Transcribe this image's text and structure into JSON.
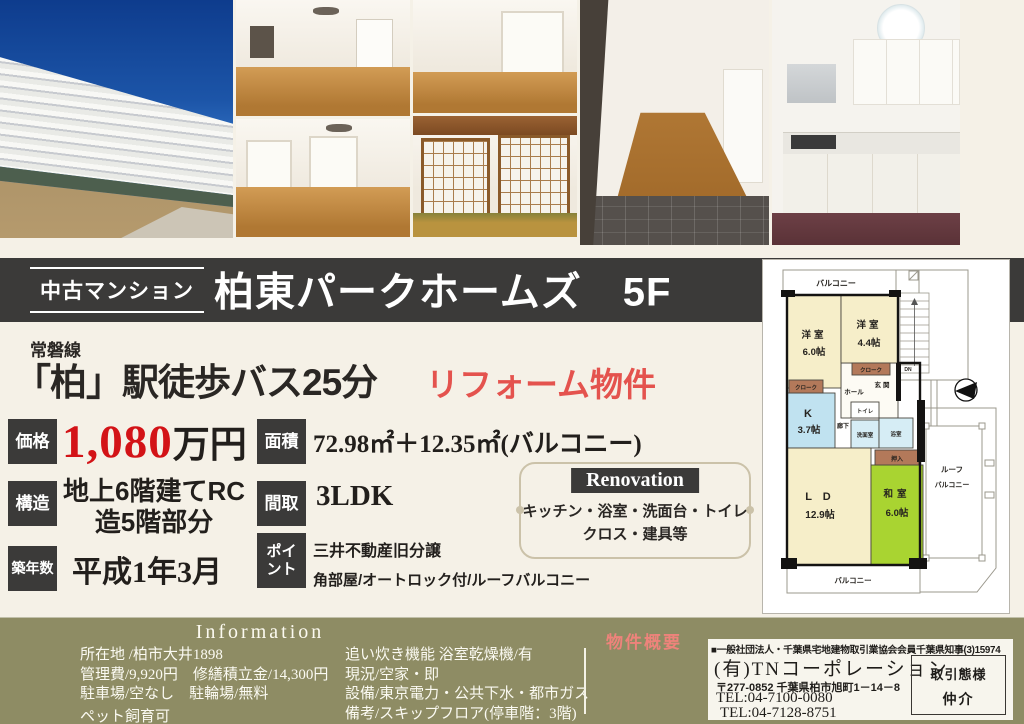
{
  "colors": {
    "background_cream": "#f5f1e7",
    "bar_charcoal": "#3b3a39",
    "price_red": "#d31317",
    "accent_coral": "#e4534e",
    "info_olive": "#8e8c64",
    "overview_pink": "#ee837b",
    "plan_room_cream": "#f6eec9",
    "plan_tatami_green": "#a9d431",
    "plan_kitchen_blue": "#c0e2f0",
    "plan_closet_brown": "#b3795a"
  },
  "title_bar": {
    "badge": "中古マンション",
    "title": "柏東パークホームズ　5F"
  },
  "catch": {
    "rail_line": "常磐線",
    "main": "「柏」駅徒歩バス25分",
    "accent": "リフォーム物件"
  },
  "specs": {
    "price": {
      "label": "価格",
      "number": "1,080",
      "unit": "万円"
    },
    "structure": {
      "label": "構造",
      "line1": "地上6階建てRC",
      "line2": "造5階部分"
    },
    "age": {
      "label": "築年数",
      "value": "平成1年3月"
    },
    "area": {
      "label": "面積",
      "value": "72.98㎡＋12.35㎡(バルコニー)"
    },
    "layout": {
      "label": "間取",
      "value": "3LDK"
    },
    "point": {
      "label1": "ポイ",
      "label2": "ント",
      "line1": "三井不動産旧分譲",
      "line2": "角部屋/オートロック付/ルーフバルコニー"
    }
  },
  "renovation": {
    "label": "Renovation",
    "line1": "キッチン・浴室・洗面台・トイレ",
    "line2": "クロス・建具等"
  },
  "floorplan": {
    "balcony_top": "バルコニー",
    "room1_name": "洋室",
    "room1_size": "6.0帖",
    "room2_name": "洋室",
    "room2_size": "4.4帖",
    "cloak1": "クローク",
    "cloak2": "クローク",
    "hall": "ホール",
    "genkan": "玄関",
    "dn": "DN",
    "kitchen_name": "K",
    "kitchen_size": "3.7帖",
    "toilet": "トイレ",
    "corridor": "廊下",
    "washroom": "洗面室",
    "bath": "浴室",
    "oshiire": "押入",
    "ld_name": "L D",
    "ld_size": "12.9帖",
    "washitsu_name": "和室",
    "washitsu_size": "6.0帖",
    "roof_balcony1": "ルーフ",
    "roof_balcony2": "バルコニー",
    "balcony_bottom": "バルコニー"
  },
  "info": {
    "heading": "Information",
    "left_lines": [
      "所在地 /柏市大井1898",
      "管理費/9,920円　修繕積立金/14,300円",
      "駐車場/空なし　駐輪場/無料",
      "ペット飼育可"
    ],
    "middle_lines": [
      "追い炊き機能 浴室乾燥機/有",
      "現況/空家・即",
      "設備/東京電力・公共下水・都市ガス",
      "備考/スキップフロア(停車階：3階)"
    ],
    "overview_label": "物件概要",
    "company": {
      "association": "■一般社団法人・千葉県宅地建物取引業協会会員千葉県知事(3)15974",
      "name": "(有)TNコーポレーション",
      "address": "〒277-0852 千葉県柏市旭町1－14－8",
      "tel1": "TEL:04-7100-0080",
      "tel2": "TEL:04-7128-8751",
      "deal_label": "取引態様",
      "deal_value": "仲介"
    }
  }
}
